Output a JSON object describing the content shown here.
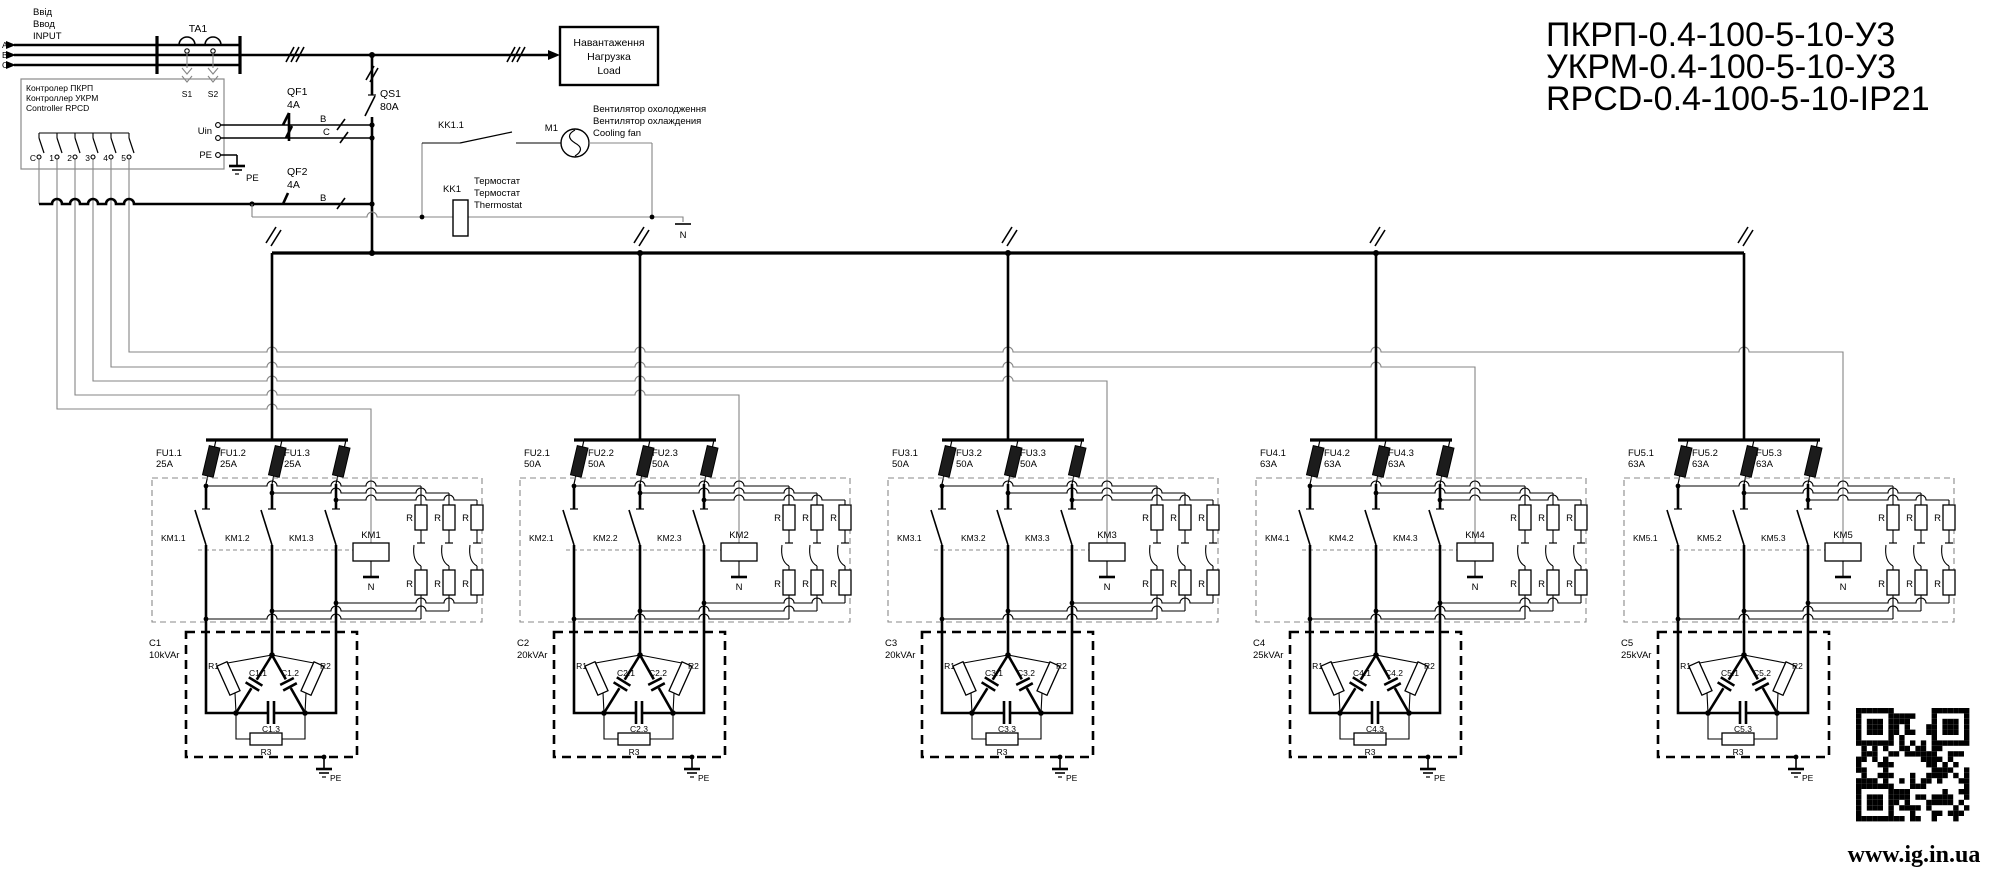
{
  "title": [
    "ПКРП-0.4-100-5-10-У3",
    "УКРМ-0.4-100-5-10-У3",
    "RPCD-0.4-100-5-10-IP21"
  ],
  "input": {
    "labels": [
      "Ввід",
      "Ввод",
      "INPUT"
    ],
    "phases": [
      "A",
      "B",
      "C"
    ]
  },
  "ta1": {
    "name": "TA1",
    "s1": "S1",
    "s2": "S2"
  },
  "controller": {
    "lines": [
      "Контролер ПКРП",
      "Контроллер УКРМ",
      "Controller RPCD"
    ],
    "uin": "Uin",
    "pe": "PE",
    "terminals": [
      "C",
      "1",
      "2",
      "3",
      "4",
      "5"
    ]
  },
  "qf1": {
    "name": "QF1",
    "rating": "4A",
    "pole_b": "B",
    "pole_c": "C"
  },
  "qf2": {
    "name": "QF2",
    "rating": "4A",
    "pole_b": "B"
  },
  "qs1": {
    "name": "QS1",
    "rating": "80A"
  },
  "pe": "PE",
  "neutral": "N",
  "load": {
    "lines": [
      "Навантаження",
      "Нагрузка",
      "Load"
    ]
  },
  "fan": {
    "contact": "KK1.1",
    "motor": "M1",
    "labels": [
      "Вентилятор охолодження",
      "Вентилятор охлаждения",
      "Cooling fan"
    ]
  },
  "thermostat": {
    "name": "KK1",
    "labels": [
      "Термостат",
      "Термостат",
      "Thermostat"
    ]
  },
  "sections": [
    {
      "fuses": [
        {
          "name": "FU1.1",
          "rating": "25A"
        },
        {
          "name": "FU1.2",
          "rating": "25A"
        },
        {
          "name": "FU1.3",
          "rating": "25A"
        }
      ],
      "contacts": [
        "KM1.1",
        "KM1.2",
        "KM1.3"
      ],
      "coil": "KM1",
      "coil_n": "N",
      "resistor": "R",
      "cap": {
        "name": "C1",
        "power": "10kVAr",
        "c1": "C1.1",
        "c2": "C1.2",
        "c3": "C1.3",
        "r1": "R1",
        "r2": "R2",
        "r3": "R3"
      }
    },
    {
      "fuses": [
        {
          "name": "FU2.1",
          "rating": "50A"
        },
        {
          "name": "FU2.2",
          "rating": "50A"
        },
        {
          "name": "FU2.3",
          "rating": "50A"
        }
      ],
      "contacts": [
        "KM2.1",
        "KM2.2",
        "KM2.3"
      ],
      "coil": "KM2",
      "coil_n": "N",
      "resistor": "R",
      "cap": {
        "name": "C2",
        "power": "20kVAr",
        "c1": "C2.1",
        "c2": "C2.2",
        "c3": "C2.3",
        "r1": "R1",
        "r2": "R2",
        "r3": "R3"
      }
    },
    {
      "fuses": [
        {
          "name": "FU3.1",
          "rating": "50A"
        },
        {
          "name": "FU3.2",
          "rating": "50A"
        },
        {
          "name": "FU3.3",
          "rating": "50A"
        }
      ],
      "contacts": [
        "KM3.1",
        "KM3.2",
        "KM3.3"
      ],
      "coil": "KM3",
      "coil_n": "N",
      "resistor": "R",
      "cap": {
        "name": "C3",
        "power": "20kVAr",
        "c1": "C3.1",
        "c2": "C3.2",
        "c3": "C3.3",
        "r1": "R1",
        "r2": "R2",
        "r3": "R3"
      }
    },
    {
      "fuses": [
        {
          "name": "FU4.1",
          "rating": "63A"
        },
        {
          "name": "FU4.2",
          "rating": "63A"
        },
        {
          "name": "FU4.3",
          "rating": "63A"
        }
      ],
      "contacts": [
        "KM4.1",
        "KM4.2",
        "KM4.3"
      ],
      "coil": "KM4",
      "coil_n": "N",
      "resistor": "R",
      "cap": {
        "name": "C4",
        "power": "25kVAr",
        "c1": "C4.1",
        "c2": "C4.2",
        "c3": "C4.3",
        "r1": "R1",
        "r2": "R2",
        "r3": "R3"
      }
    },
    {
      "fuses": [
        {
          "name": "FU5.1",
          "rating": "63A"
        },
        {
          "name": "FU5.2",
          "rating": "63A"
        },
        {
          "name": "FU5.3",
          "rating": "63A"
        }
      ],
      "contacts": [
        "KM5.1",
        "KM5.2",
        "KM5.3"
      ],
      "coil": "KM5",
      "coil_n": "N",
      "resistor": "R",
      "cap": {
        "name": "C5",
        "power": "25kVAr",
        "c1": "C5.1",
        "c2": "C5.2",
        "c3": "C5.3",
        "r1": "R1",
        "r2": "R2",
        "r3": "R3"
      }
    }
  ],
  "footer": {
    "url": "www.ig.in.ua"
  }
}
